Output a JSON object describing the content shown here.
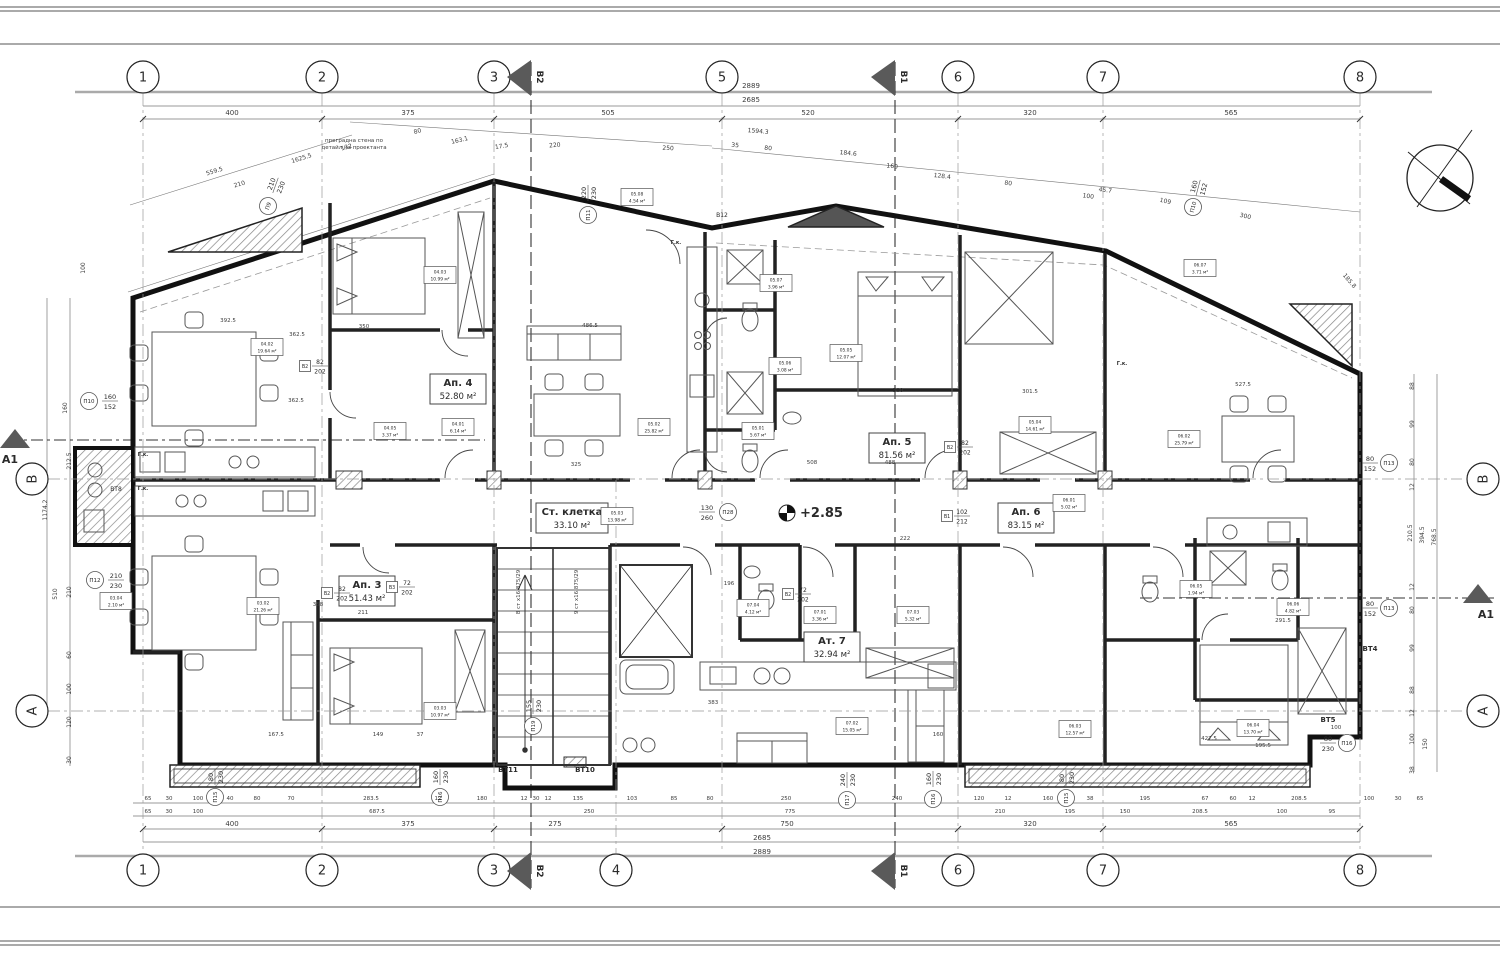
{
  "meta": {
    "sheet_type": "architectural floor plan"
  },
  "notes": {
    "partition_line1": "преградна стена по",
    "partition_line2": "детайл на проектанта",
    "elevation": "+2.85",
    "stair_right": "9 ст x16.875/29",
    "stair_left": "8 ст x16.875/29"
  },
  "axes": {
    "top": [
      [
        "1",
        143
      ],
      [
        "2",
        322
      ],
      [
        "3",
        494
      ],
      [
        "5",
        722
      ],
      [
        "6",
        958
      ],
      [
        "7",
        1103
      ],
      [
        "8",
        1360
      ]
    ],
    "bottom": [
      [
        "1",
        143
      ],
      [
        "2",
        322
      ],
      [
        "3",
        494
      ],
      [
        "4",
        616
      ],
      [
        "6",
        958
      ],
      [
        "7",
        1103
      ],
      [
        "8",
        1360
      ]
    ],
    "left": [
      [
        "B",
        479
      ],
      [
        "A",
        711
      ]
    ],
    "right": [
      [
        "B",
        479
      ],
      [
        "A",
        711
      ]
    ],
    "flags": [
      [
        "B2",
        531
      ],
      [
        "B1",
        895
      ]
    ],
    "arrows": [
      [
        "A1",
        15,
        437,
        "left"
      ],
      [
        "A1",
        1478,
        592,
        "right"
      ]
    ]
  },
  "apartments": [
    {
      "name": "Ап. 4",
      "area": "52.80 м²",
      "x": 458,
      "y": 390,
      "w": 56
    },
    {
      "name": "Ап. 5",
      "area": "81.56 м²",
      "x": 897,
      "y": 449,
      "w": 56
    },
    {
      "name": "Ап. 6",
      "area": "83.15 м²",
      "x": 1026,
      "y": 519,
      "w": 56
    },
    {
      "name": "Ап. 3",
      "area": "51.43 м²",
      "x": 367,
      "y": 592,
      "w": 56
    },
    {
      "name": "Ат. 7",
      "area": "32.94 м²",
      "x": 832,
      "y": 648,
      "w": 56
    },
    {
      "name": "Ст. клетка",
      "area": "33.10 м²",
      "x": 572,
      "y": 519,
      "w": 72
    }
  ],
  "rooms": [
    [
      "03.02",
      "21.26 м²",
      263,
      606
    ],
    [
      "03.03",
      "10.97 м²",
      440,
      711
    ],
    [
      "03.04",
      "2.10 м²",
      116,
      601
    ],
    [
      "04.01",
      "6.14 м²",
      458,
      427
    ],
    [
      "04.02",
      "19.64 м²",
      267,
      347
    ],
    [
      "04.03",
      "10.99 м²",
      440,
      275
    ],
    [
      "04.05",
      "3.37 м²",
      390,
      431
    ],
    [
      "05.01",
      "5.67 м²",
      758,
      431
    ],
    [
      "05.02",
      "25.82 м²",
      654,
      427
    ],
    [
      "05.03",
      "13.98 м²",
      617,
      516
    ],
    [
      "05.04",
      "14.61 м²",
      1035,
      425
    ],
    [
      "05.05",
      "12.07 м²",
      846,
      353
    ],
    [
      "05.06",
      "3.08 м²",
      785,
      366
    ],
    [
      "05.07",
      "3.96 м²",
      776,
      283
    ],
    [
      "05.08",
      "4.54 м²",
      637,
      197
    ],
    [
      "06.01",
      "5.02 м²",
      1069,
      503
    ],
    [
      "06.02",
      "25.79 м²",
      1184,
      439
    ],
    [
      "06.03",
      "12.57 м²",
      1075,
      729
    ],
    [
      "06.04",
      "13.70 м²",
      1253,
      728
    ],
    [
      "06.05",
      "1.94 м²",
      1196,
      589
    ],
    [
      "06.06",
      "4.82 м²",
      1293,
      607
    ],
    [
      "06.07",
      "3.71 м²",
      1200,
      268
    ],
    [
      "07.01",
      "3.36 м²",
      820,
      615
    ],
    [
      "07.02",
      "15.05 м²",
      852,
      726
    ],
    [
      "07.03",
      "5.32 м²",
      913,
      615
    ],
    [
      "07.04",
      "4.12 м²",
      753,
      608
    ]
  ],
  "tags": [
    [
      "П10",
      "160",
      "152",
      89,
      401,
      0,
      21
    ],
    [
      "П12",
      "210",
      "230",
      95,
      580,
      0,
      21
    ],
    [
      "П9",
      "210",
      "230",
      268,
      206,
      -70,
      22
    ],
    [
      "П11",
      "220",
      "230",
      588,
      215,
      -90,
      22
    ],
    [
      "П28",
      "130",
      "260",
      728,
      512,
      0,
      -21
    ],
    [
      "П13",
      "80",
      "152",
      1389,
      463,
      0,
      -19
    ],
    [
      "П13",
      "80",
      "152",
      1389,
      608,
      0,
      -19
    ],
    [
      "П16",
      "80",
      "230",
      1347,
      743,
      0,
      -19
    ],
    [
      "П15",
      "80",
      "230",
      215,
      797,
      -90,
      20
    ],
    [
      "П16",
      "160",
      "230",
      440,
      797,
      -90,
      20
    ],
    [
      "П17",
      "240",
      "230",
      847,
      800,
      -90,
      20
    ],
    [
      "П16",
      "160",
      "230",
      933,
      799,
      -90,
      20
    ],
    [
      "П15",
      "80",
      "230",
      1066,
      798,
      -90,
      20
    ],
    [
      "П19",
      "155",
      "230",
      533,
      726,
      -90,
      20
    ],
    [
      "П10",
      "160",
      "152",
      1193,
      207,
      -75,
      20
    ]
  ],
  "btags": [
    [
      "В1",
      "102",
      "212",
      947,
      516
    ],
    [
      "В2",
      "82",
      "202",
      950,
      447
    ],
    [
      "В2",
      "82",
      "202",
      327,
      593
    ],
    [
      "В2",
      "82",
      "202",
      305,
      366
    ],
    [
      "В3",
      "72",
      "202",
      392,
      587
    ],
    [
      "В2",
      "72",
      "202",
      788,
      594
    ]
  ],
  "dims": [
    [
      "2889",
      751,
      88,
      0,
      7
    ],
    [
      "2685",
      751,
      102,
      0,
      7
    ],
    [
      "400",
      232,
      115,
      0,
      7
    ],
    [
      "375",
      408,
      115,
      0,
      7
    ],
    [
      "505",
      608,
      115,
      0,
      7
    ],
    [
      "520",
      808,
      115,
      0,
      7
    ],
    [
      "320",
      1030,
      115,
      0,
      7
    ],
    [
      "565",
      1231,
      115,
      0,
      7
    ],
    [
      "559.5",
      215,
      173,
      -17,
      6
    ],
    [
      "210",
      240,
      186,
      -17,
      6
    ],
    [
      "1625.5",
      302,
      160,
      -17,
      6
    ],
    [
      "132",
      347,
      149,
      -17,
      6
    ],
    [
      "80",
      418,
      133,
      -15,
      6
    ],
    [
      "163.1",
      460,
      142,
      -13,
      6
    ],
    [
      "17.5",
      502,
      148,
      -10,
      6
    ],
    [
      "220",
      555,
      147,
      -5,
      6
    ],
    [
      "250",
      668,
      150,
      3,
      6
    ],
    [
      "1594.3",
      758,
      133,
      5,
      6
    ],
    [
      "35",
      735,
      147,
      5,
      6
    ],
    [
      "80",
      768,
      150,
      5,
      6
    ],
    [
      "184.6",
      848,
      155,
      6,
      6
    ],
    [
      "160",
      892,
      168,
      6,
      6
    ],
    [
      "128.4",
      942,
      178,
      7,
      6
    ],
    [
      "80",
      1008,
      185,
      7,
      6
    ],
    [
      "45.7",
      1105,
      192,
      8,
      6
    ],
    [
      "109",
      1165,
      203,
      12,
      6
    ],
    [
      "300",
      1245,
      218,
      13,
      6
    ],
    [
      "185.8",
      1348,
      282,
      50,
      6
    ],
    [
      "100",
      1088,
      198,
      8,
      6
    ],
    [
      "65",
      148,
      800,
      0,
      5.5
    ],
    [
      "30",
      169,
      800,
      0,
      5.5
    ],
    [
      "100",
      198,
      800,
      0,
      5.5
    ],
    [
      "40",
      230,
      800,
      0,
      5.5
    ],
    [
      "80",
      257,
      800,
      0,
      5.5
    ],
    [
      "70",
      291,
      800,
      0,
      5.5
    ],
    [
      "283.5",
      371,
      800,
      0,
      5.5
    ],
    [
      "12",
      438,
      800,
      0,
      5.5
    ],
    [
      "180",
      482,
      800,
      0,
      5.5
    ],
    [
      "12",
      524,
      800,
      0,
      5.5
    ],
    [
      "30",
      536,
      800,
      0,
      5.5
    ],
    [
      "12",
      548,
      800,
      0,
      5.5
    ],
    [
      "135",
      578,
      800,
      0,
      5.5
    ],
    [
      "103",
      632,
      800,
      0,
      5.5
    ],
    [
      "85",
      674,
      800,
      0,
      5.5
    ],
    [
      "80",
      710,
      800,
      0,
      5.5
    ],
    [
      "250",
      786,
      800,
      0,
      5.5
    ],
    [
      "240",
      897,
      800,
      0,
      5.5
    ],
    [
      "120",
      979,
      800,
      0,
      5.5
    ],
    [
      "12",
      1008,
      800,
      0,
      5.5
    ],
    [
      "160",
      1048,
      800,
      0,
      5.5
    ],
    [
      "38",
      1090,
      800,
      0,
      5.5
    ],
    [
      "195",
      1145,
      800,
      0,
      5.5
    ],
    [
      "67",
      1205,
      800,
      0,
      5.5
    ],
    [
      "60",
      1233,
      800,
      0,
      5.5
    ],
    [
      "12",
      1252,
      800,
      0,
      5.5
    ],
    [
      "208.5",
      1299,
      800,
      0,
      5.5
    ],
    [
      "100",
      1369,
      800,
      0,
      5.5
    ],
    [
      "30",
      1398,
      800,
      0,
      5.5
    ],
    [
      "65",
      1420,
      800,
      0,
      5.5
    ],
    [
      "65",
      148,
      813,
      0,
      5.5
    ],
    [
      "30",
      169,
      813,
      0,
      5.5
    ],
    [
      "100",
      198,
      813,
      0,
      5.5
    ],
    [
      "687.5",
      377,
      813,
      0,
      5.5
    ],
    [
      "250",
      589,
      813,
      0,
      5.5
    ],
    [
      "775",
      790,
      813,
      0,
      5.5
    ],
    [
      "210",
      1000,
      813,
      0,
      5.5
    ],
    [
      "195",
      1070,
      813,
      0,
      5.5
    ],
    [
      "150",
      1125,
      813,
      0,
      5.5
    ],
    [
      "208.5",
      1200,
      813,
      0,
      5.5
    ],
    [
      "100",
      1282,
      813,
      0,
      5.5
    ],
    [
      "95",
      1332,
      813,
      0,
      5.5
    ],
    [
      "400",
      232,
      826,
      0,
      7
    ],
    [
      "375",
      408,
      826,
      0,
      7
    ],
    [
      "275",
      555,
      826,
      0,
      7
    ],
    [
      "750",
      787,
      826,
      0,
      7
    ],
    [
      "320",
      1030,
      826,
      0,
      7
    ],
    [
      "565",
      1231,
      826,
      0,
      7
    ],
    [
      "2685",
      762,
      840,
      0,
      7
    ],
    [
      "2889",
      762,
      854,
      0,
      7
    ],
    [
      "100",
      85,
      268,
      -90,
      6
    ],
    [
      "160",
      67,
      408,
      -90,
      6
    ],
    [
      "212.5",
      71,
      461,
      -90,
      6
    ],
    [
      "1174.2",
      47,
      510,
      -90,
      6
    ],
    [
      "510",
      57,
      594,
      -90,
      6
    ],
    [
      "210",
      71,
      592,
      -90,
      6
    ],
    [
      "60",
      71,
      655,
      -90,
      6
    ],
    [
      "100",
      71,
      689,
      -90,
      6
    ],
    [
      "120",
      71,
      722,
      -90,
      6
    ],
    [
      "30",
      71,
      760,
      -90,
      6
    ],
    [
      "88",
      1414,
      386,
      -90,
      6
    ],
    [
      "99",
      1414,
      424,
      -90,
      6
    ],
    [
      "80",
      1414,
      462,
      -90,
      6
    ],
    [
      "12",
      1414,
      487,
      -90,
      6
    ],
    [
      "210.5",
      1412,
      533,
      -90,
      6
    ],
    [
      "394.5",
      1424,
      535,
      -90,
      6
    ],
    [
      "768.5",
      1436,
      537,
      -90,
      6
    ],
    [
      "12",
      1414,
      587,
      -90,
      6
    ],
    [
      "80",
      1414,
      610,
      -90,
      6
    ],
    [
      "99",
      1414,
      648,
      -90,
      6
    ],
    [
      "88",
      1414,
      690,
      -90,
      6
    ],
    [
      "12",
      1414,
      713,
      -90,
      6
    ],
    [
      "100",
      1414,
      739,
      -90,
      6
    ],
    [
      "150",
      1427,
      744,
      -90,
      6
    ],
    [
      "38",
      1414,
      770,
      -90,
      6
    ],
    [
      "362.5",
      297,
      336,
      0,
      5.5
    ],
    [
      "392.5",
      228,
      322,
      0,
      5.5
    ],
    [
      "350",
      364,
      328,
      0,
      5.5
    ],
    [
      "325",
      576,
      466,
      0,
      5.5
    ],
    [
      "486.5",
      590,
      327,
      0,
      5.5
    ],
    [
      "508",
      812,
      464,
      0,
      5.5
    ],
    [
      "488",
      890,
      464,
      0,
      5.5
    ],
    [
      "222",
      905,
      540,
      0,
      5.5
    ],
    [
      "358",
      318,
      606,
      0,
      5.5
    ],
    [
      "211",
      363,
      614,
      0,
      5.5
    ],
    [
      "167.5",
      276,
      736,
      0,
      5.5
    ],
    [
      "149",
      378,
      736,
      0,
      5.5
    ],
    [
      "37",
      420,
      736,
      0,
      5.5
    ],
    [
      "160",
      938,
      736,
      0,
      5.5
    ],
    [
      "383",
      713,
      704,
      0,
      5.5
    ],
    [
      "300",
      898,
      392,
      0,
      5.5
    ],
    [
      "301.5",
      1030,
      393,
      0,
      5.5
    ],
    [
      "527.5",
      1243,
      386,
      0,
      5.5
    ],
    [
      "196",
      729,
      585,
      0,
      5.5
    ],
    [
      "195.5",
      1263,
      747,
      0,
      5.5
    ],
    [
      "291.5",
      1283,
      622,
      0,
      5.5
    ],
    [
      "427.5",
      1209,
      740,
      0,
      5.5
    ],
    [
      "362.5",
      296,
      402,
      0,
      5.5
    ],
    [
      "100",
      1336,
      729,
      0,
      5.5
    ]
  ],
  "texts": [
    [
      "ВТ8",
      116,
      491,
      0,
      6,
      0
    ],
    [
      "ВТ11",
      508,
      772,
      0,
      7,
      1
    ],
    [
      "ВТ10",
      585,
      772,
      0,
      7,
      1
    ],
    [
      "ВТ4",
      1370,
      651,
      0,
      7,
      1
    ],
    [
      "ВТ5",
      1328,
      722,
      0,
      7,
      1
    ],
    [
      "В12",
      722,
      217,
      0,
      6,
      0
    ],
    [
      "Г.к.",
      143,
      456,
      0,
      5,
      1
    ],
    [
      "Г.к.",
      143,
      490,
      0,
      5,
      1
    ],
    [
      "Г.к.",
      676,
      244,
      0,
      5,
      1
    ],
    [
      "Г.к.",
      1122,
      365,
      0,
      5,
      1
    ]
  ]
}
